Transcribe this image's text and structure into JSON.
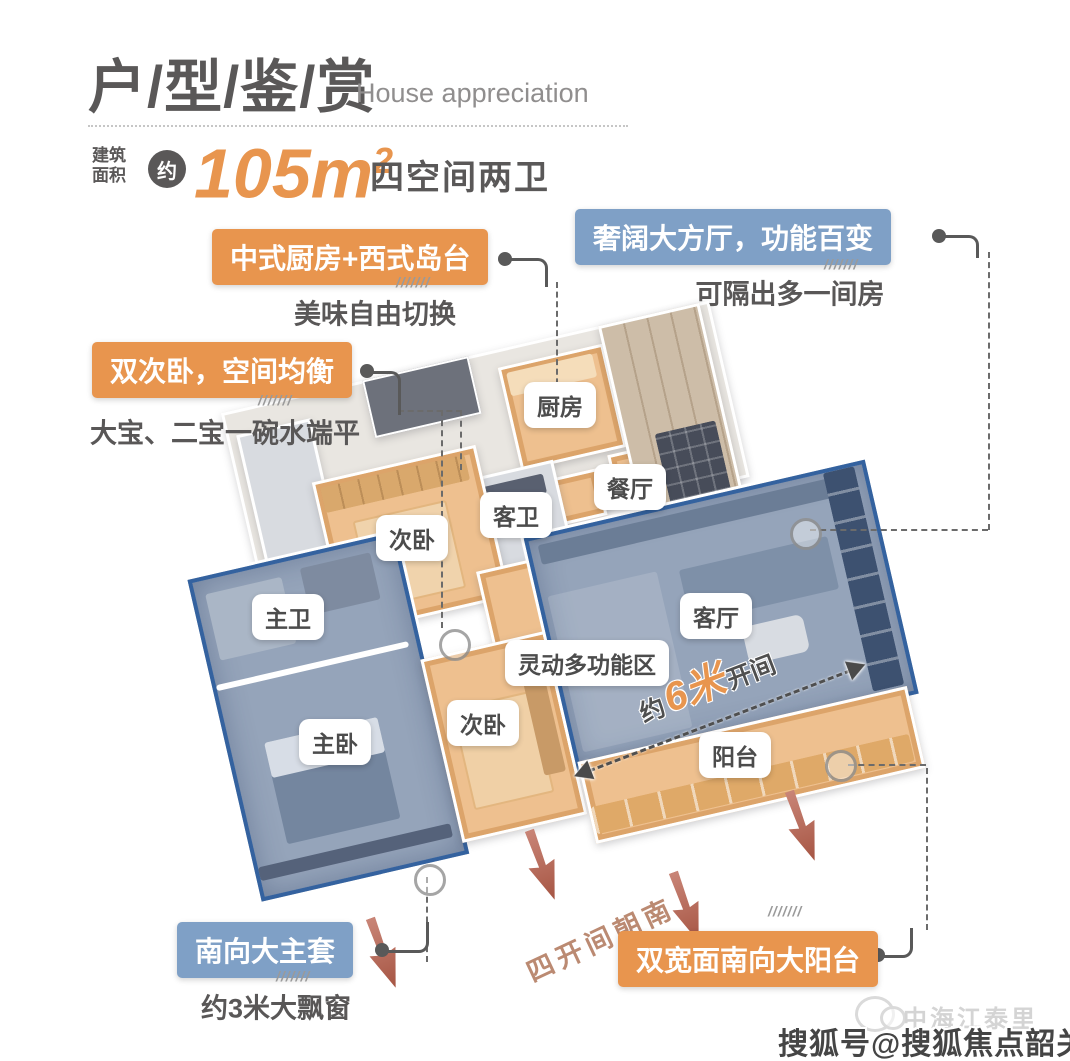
{
  "header": {
    "title": "户/型/鉴/赏",
    "subtitle": "House appreciation",
    "area_label_top": "建筑",
    "area_label_bottom": "面积",
    "approx_badge": "约",
    "area_value": "105",
    "area_unit": "m",
    "area_exponent": "2",
    "spec": "四空间两卫"
  },
  "callouts": {
    "kitchen": {
      "label": "中式厨房+西式岛台",
      "desc": "美味自由切换"
    },
    "hall": {
      "label": "奢阔大方厅，功能百变",
      "desc": "可隔出多一间房"
    },
    "twin_bedrooms": {
      "label": "双次卧，空间均衡",
      "desc": "大宝、二宝一碗水端平"
    },
    "master_suite": {
      "label": "南向大主套",
      "desc": "约3米大飘窗"
    },
    "balcony": {
      "label": "双宽面南向大阳台"
    }
  },
  "rooms": {
    "kitchen": "厨房",
    "dining": "餐厅",
    "guest_bath": "客卫",
    "bedroom2": "次卧",
    "master_bath": "主卫",
    "master_bedroom": "主卧",
    "bedroom3": "次卧",
    "multi_zone": "灵动多功能区",
    "living": "客厅",
    "balcony": "阳台"
  },
  "annotations": {
    "span_prefix": "约",
    "span_value": "6米",
    "span_suffix": "开间",
    "south_text": "四开间朝南",
    "hatch": "///////"
  },
  "watermark": {
    "brand": "中海江泰里",
    "account": "搜狐号@搜狐焦点韶关站"
  },
  "colors": {
    "orange_accent": "#e8954e",
    "blue_accent": "#7fa0c6",
    "dark_text": "#595757",
    "arrow_red": "#b96a58",
    "room_blue_border": "#34629f"
  }
}
